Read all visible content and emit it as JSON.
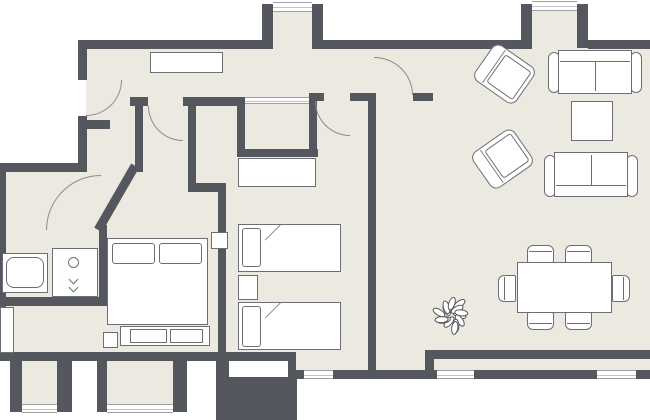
{
  "canvas": {
    "w": 650,
    "h": 420,
    "bg": "#ffffff",
    "floor_color": "#ebe9e0",
    "wall_color": "#54585e",
    "furniture_border": "#6b6f74",
    "arc_color": "#8a8d91"
  },
  "rooms": [
    {
      "name": "hallway"
    },
    {
      "name": "entry-vestibule"
    },
    {
      "name": "closet"
    },
    {
      "name": "bathroom"
    },
    {
      "name": "bedroom-1"
    },
    {
      "name": "bedroom-2"
    },
    {
      "name": "living-room"
    },
    {
      "name": "dining-area"
    },
    {
      "name": "balcony"
    }
  ],
  "floors": [
    {
      "name": "floor-main",
      "x": 86,
      "y": 48,
      "w": 564,
      "h": 304
    },
    {
      "name": "floor-bathroom",
      "x": 0,
      "y": 171,
      "w": 103,
      "h": 135
    },
    {
      "name": "floor-bedroom1-west",
      "x": 0,
      "y": 306,
      "w": 230,
      "h": 46
    },
    {
      "name": "floor-vestibule-bay",
      "x": 273,
      "y": 11,
      "w": 39,
      "h": 38
    },
    {
      "name": "floor-living-bay",
      "x": 532,
      "y": 10,
      "w": 45,
      "h": 39
    },
    {
      "name": "floor-south-niche-1",
      "x": 22,
      "y": 361,
      "w": 35,
      "h": 43
    },
    {
      "name": "floor-south-niche-2",
      "x": 107,
      "y": 361,
      "w": 66,
      "h": 43
    },
    {
      "name": "floor-bedroom2-bay",
      "x": 296,
      "y": 352,
      "w": 72,
      "h": 27
    },
    {
      "name": "floor-living-south",
      "x": 376,
      "y": 352,
      "w": 49,
      "h": 18
    },
    {
      "name": "floor-balcony-strip",
      "x": 425,
      "y": 350,
      "w": 225,
      "h": 20
    }
  ],
  "walls": [
    {
      "name": "wall-top-west",
      "x": 78,
      "y": 40,
      "w": 186,
      "h": 9
    },
    {
      "name": "wall-top-mid",
      "x": 323,
      "y": 40,
      "w": 198,
      "h": 9
    },
    {
      "name": "wall-top-east",
      "x": 588,
      "y": 40,
      "w": 62,
      "h": 9
    },
    {
      "name": "wall-vestibule-bay-left",
      "x": 262,
      "y": 4,
      "w": 11,
      "h": 45
    },
    {
      "name": "wall-vestibule-bay-right",
      "x": 312,
      "y": 4,
      "w": 11,
      "h": 45
    },
    {
      "name": "wall-living-bay-left",
      "x": 521,
      "y": 4,
      "w": 11,
      "h": 45
    },
    {
      "name": "wall-living-bay-right",
      "x": 577,
      "y": 4,
      "w": 11,
      "h": 44
    },
    {
      "name": "wall-left-upper",
      "x": 78,
      "y": 40,
      "w": 9,
      "h": 40
    },
    {
      "name": "wall-left-mid",
      "x": 78,
      "y": 116,
      "w": 9,
      "h": 56
    },
    {
      "name": "wall-west-horizontal",
      "x": 0,
      "y": 163,
      "w": 87,
      "h": 9
    },
    {
      "name": "wall-left-edge",
      "x": 0,
      "y": 171,
      "w": 6,
      "h": 187
    },
    {
      "name": "wall-entry-stub",
      "x": 82,
      "y": 120,
      "w": 28,
      "h": 9
    },
    {
      "name": "wall-bathroom-east",
      "x": 99,
      "y": 225,
      "w": 8,
      "h": 81
    },
    {
      "name": "wall-bathroom-south",
      "x": 0,
      "y": 297,
      "w": 107,
      "h": 9
    },
    {
      "name": "wall-diagonal",
      "x": 139,
      "y": 168,
      "w": 74,
      "h": 9,
      "rot": 120,
      "origin": "tl"
    },
    {
      "name": "wall-hall-a1",
      "x": 130,
      "y": 97,
      "w": 18,
      "h": 9
    },
    {
      "name": "wall-hall-a2",
      "x": 183,
      "y": 97,
      "w": 56,
      "h": 9
    },
    {
      "name": "wall-closet-west",
      "x": 237,
      "y": 97,
      "w": 8,
      "h": 60
    },
    {
      "name": "wall-closet-south",
      "x": 237,
      "y": 149,
      "w": 81,
      "h": 8
    },
    {
      "name": "wall-closet-east",
      "x": 309,
      "y": 97,
      "w": 8,
      "h": 60
    },
    {
      "name": "wall-hall-south-1",
      "x": 309,
      "y": 93,
      "w": 15,
      "h": 8
    },
    {
      "name": "wall-hall-south-2",
      "x": 350,
      "y": 93,
      "w": 24,
      "h": 8
    },
    {
      "name": "wall-hall-south-3",
      "x": 413,
      "y": 93,
      "w": 20,
      "h": 8
    },
    {
      "name": "wall-living-west",
      "x": 368,
      "y": 93,
      "w": 8,
      "h": 286
    },
    {
      "name": "wall-corridor-west",
      "x": 135,
      "y": 105,
      "w": 8,
      "h": 67
    },
    {
      "name": "wall-corridor-east",
      "x": 188,
      "y": 105,
      "w": 8,
      "h": 85
    },
    {
      "name": "wall-corridor-jog",
      "x": 188,
      "y": 183,
      "w": 38,
      "h": 9
    },
    {
      "name": "wall-bedrooms-divider",
      "x": 218,
      "y": 183,
      "w": 8,
      "h": 178
    },
    {
      "name": "wall-bedroom1-south",
      "x": 0,
      "y": 352,
      "w": 296,
      "h": 9
    },
    {
      "name": "wall-south-stub-1",
      "x": 10,
      "y": 361,
      "w": 12,
      "h": 51
    },
    {
      "name": "wall-south-stub-2",
      "x": 57,
      "y": 361,
      "w": 15,
      "h": 51
    },
    {
      "name": "wall-south-stub-3",
      "x": 97,
      "y": 361,
      "w": 10,
      "h": 51
    },
    {
      "name": "wall-south-stub-4",
      "x": 173,
      "y": 361,
      "w": 14,
      "h": 51
    },
    {
      "name": "wall-south-step-1",
      "x": 216,
      "y": 361,
      "w": 13,
      "h": 59
    },
    {
      "name": "wall-south-step-2",
      "x": 229,
      "y": 377,
      "w": 68,
      "h": 43
    },
    {
      "name": "wall-bedroom2-bay-west",
      "x": 288,
      "y": 352,
      "w": 8,
      "h": 27
    },
    {
      "name": "wall-living-south",
      "x": 425,
      "y": 350,
      "w": 225,
      "h": 9
    },
    {
      "name": "wall-balcony-connector",
      "x": 425,
      "y": 350,
      "w": 9,
      "h": 29
    },
    {
      "name": "wall-south-outer",
      "x": 296,
      "y": 370,
      "w": 354,
      "h": 9
    }
  ],
  "windows": [
    {
      "name": "window-vestibule-bay",
      "x": 273,
      "y": 2,
      "w": 39,
      "h": 10
    },
    {
      "name": "window-living-bay",
      "x": 532,
      "y": 1,
      "w": 45,
      "h": 10
    },
    {
      "name": "window-south-niche-1",
      "x": 22,
      "y": 404,
      "w": 35,
      "h": 9
    },
    {
      "name": "window-south-niche-2",
      "x": 107,
      "y": 404,
      "w": 66,
      "h": 9
    },
    {
      "name": "window-bedroom2-bay",
      "x": 304,
      "y": 370,
      "w": 29,
      "h": 9
    },
    {
      "name": "window-balcony-1",
      "x": 437,
      "y": 370,
      "w": 37,
      "h": 9
    },
    {
      "name": "window-balcony-2",
      "x": 597,
      "y": 370,
      "w": 39,
      "h": 9
    },
    {
      "name": "closet-sliding-door",
      "x": 245,
      "y": 97,
      "w": 64,
      "h": 7
    }
  ],
  "doors": [
    {
      "name": "entry-door-arc",
      "x": 86,
      "y": 80,
      "w": 36,
      "h": 36,
      "corner": "br"
    },
    {
      "name": "corridor-door-arc",
      "x": 148,
      "y": 106,
      "w": 35,
      "h": 35,
      "corner": "bl"
    },
    {
      "name": "bedroom2-door-arc",
      "x": 315,
      "y": 101,
      "w": 35,
      "h": 35,
      "corner": "bl"
    },
    {
      "name": "living-door-arc",
      "x": 374,
      "y": 57,
      "w": 39,
      "h": 38,
      "corner": "tr"
    },
    {
      "name": "bathroom-door-arc",
      "x": 46,
      "y": 175,
      "w": 55,
      "h": 55,
      "corner": "tl"
    }
  ],
  "furniture": [
    {
      "name": "hall-cabinet",
      "kind": "box",
      "x": 150,
      "y": 52,
      "w": 73,
      "h": 21
    },
    {
      "name": "wardrobe",
      "kind": "box",
      "x": 238,
      "y": 158,
      "w": 78,
      "h": 29
    },
    {
      "name": "single-bed-1",
      "kind": "box",
      "x": 238,
      "y": 224,
      "w": 103,
      "h": 48
    },
    {
      "name": "single-bed-1-pillow",
      "kind": "pillow",
      "x": 242,
      "y": 228,
      "w": 19,
      "h": 39
    },
    {
      "name": "single-bed-1-fold",
      "kind": "line",
      "x": 281,
      "y": 225,
      "w": 22,
      "h": 1,
      "rot": 135,
      "origin": "tl"
    },
    {
      "name": "bedroom2-nightstand",
      "kind": "box",
      "x": 238,
      "y": 275,
      "w": 20,
      "h": 25
    },
    {
      "name": "single-bed-2",
      "kind": "box",
      "x": 238,
      "y": 302,
      "w": 103,
      "h": 48
    },
    {
      "name": "single-bed-2-pillow",
      "kind": "pillow",
      "x": 242,
      "y": 306,
      "w": 19,
      "h": 41
    },
    {
      "name": "single-bed-2-fold",
      "kind": "line",
      "x": 281,
      "y": 303,
      "w": 22,
      "h": 1,
      "rot": 135,
      "origin": "tl"
    },
    {
      "name": "double-bed",
      "kind": "box",
      "x": 107,
      "y": 238,
      "w": 101,
      "h": 87
    },
    {
      "name": "double-bed-pillow-left",
      "kind": "pillow",
      "x": 112,
      "y": 243,
      "w": 43,
      "h": 21
    },
    {
      "name": "double-bed-pillow-right",
      "kind": "pillow",
      "x": 159,
      "y": 243,
      "w": 43,
      "h": 21
    },
    {
      "name": "bed-bench",
      "kind": "box",
      "x": 120,
      "y": 326,
      "w": 90,
      "h": 20
    },
    {
      "name": "bed-bench-cushion-1",
      "kind": "box",
      "x": 130,
      "y": 329,
      "w": 37,
      "h": 14
    },
    {
      "name": "bed-bench-cushion-2",
      "kind": "box",
      "x": 170,
      "y": 329,
      "w": 33,
      "h": 14
    },
    {
      "name": "bedroom1-nightstand-1",
      "kind": "box",
      "x": 103,
      "y": 332,
      "w": 15,
      "h": 16
    },
    {
      "name": "bedroom1-nightstand-2",
      "kind": "box",
      "x": 211,
      "y": 232,
      "w": 17,
      "h": 17
    },
    {
      "name": "bedroom1-shelf",
      "kind": "box",
      "x": 0,
      "y": 307,
      "w": 14,
      "h": 46
    },
    {
      "name": "bathtub",
      "kind": "box",
      "x": 2,
      "y": 253,
      "w": 46,
      "h": 40
    },
    {
      "name": "bathtub-inner",
      "kind": "box-r",
      "x": 6,
      "y": 257,
      "w": 38,
      "h": 31
    },
    {
      "name": "washing-machine",
      "kind": "box",
      "x": 52,
      "y": 248,
      "w": 46,
      "h": 49
    },
    {
      "name": "washing-machine-door",
      "kind": "circle",
      "x": 68,
      "y": 257,
      "w": 11,
      "h": 11
    },
    {
      "name": "washing-machine-symbol-1",
      "kind": "chev",
      "x": 70,
      "y": 276,
      "w": 7,
      "h": 7
    },
    {
      "name": "washing-machine-symbol-2",
      "kind": "chev",
      "x": 70,
      "y": 284,
      "w": 7,
      "h": 7
    },
    {
      "name": "armchair-1",
      "kind": "armchair",
      "x": 479,
      "y": 52,
      "w": 51,
      "h": 44,
      "rot": 35
    },
    {
      "name": "armchair-2",
      "kind": "armchair",
      "x": 477,
      "y": 137,
      "w": 51,
      "h": 44,
      "rot": -35
    },
    {
      "name": "sofa-1-arm-left",
      "kind": "box-r",
      "x": 548,
      "y": 52,
      "w": 12,
      "h": 41
    },
    {
      "name": "sofa-1-arm-right",
      "kind": "box-r",
      "x": 630,
      "y": 52,
      "w": 12,
      "h": 41
    },
    {
      "name": "sofa-1",
      "kind": "sofa-n",
      "x": 558,
      "y": 50,
      "w": 74,
      "h": 44
    },
    {
      "name": "coffee-table",
      "kind": "box",
      "x": 571,
      "y": 101,
      "w": 42,
      "h": 40
    },
    {
      "name": "sofa-2-arm-left",
      "kind": "box-r",
      "x": 544,
      "y": 155,
      "w": 12,
      "h": 42
    },
    {
      "name": "sofa-2-arm-right",
      "kind": "box-r",
      "x": 626,
      "y": 155,
      "w": 12,
      "h": 42
    },
    {
      "name": "sofa-2",
      "kind": "sofa-s",
      "x": 554,
      "y": 152,
      "w": 74,
      "h": 45
    },
    {
      "name": "dining-chair-n1",
      "kind": "chair-n",
      "x": 527,
      "y": 245,
      "w": 27,
      "h": 18
    },
    {
      "name": "dining-chair-n2",
      "kind": "chair-n",
      "x": 565,
      "y": 245,
      "w": 27,
      "h": 18
    },
    {
      "name": "dining-table",
      "kind": "box",
      "x": 517,
      "y": 262,
      "w": 95,
      "h": 51
    },
    {
      "name": "dining-chair-s1",
      "kind": "chair-s",
      "x": 527,
      "y": 312,
      "w": 27,
      "h": 18
    },
    {
      "name": "dining-chair-s2",
      "kind": "chair-s",
      "x": 565,
      "y": 312,
      "w": 27,
      "h": 18
    },
    {
      "name": "dining-chair-w",
      "kind": "chair-w",
      "x": 498,
      "y": 275,
      "w": 18,
      "h": 27
    },
    {
      "name": "dining-chair-e",
      "kind": "chair-e",
      "x": 612,
      "y": 275,
      "w": 18,
      "h": 27
    },
    {
      "name": "plant-icon",
      "kind": "plant",
      "x": 429,
      "y": 291,
      "w": 46,
      "h": 48
    }
  ]
}
